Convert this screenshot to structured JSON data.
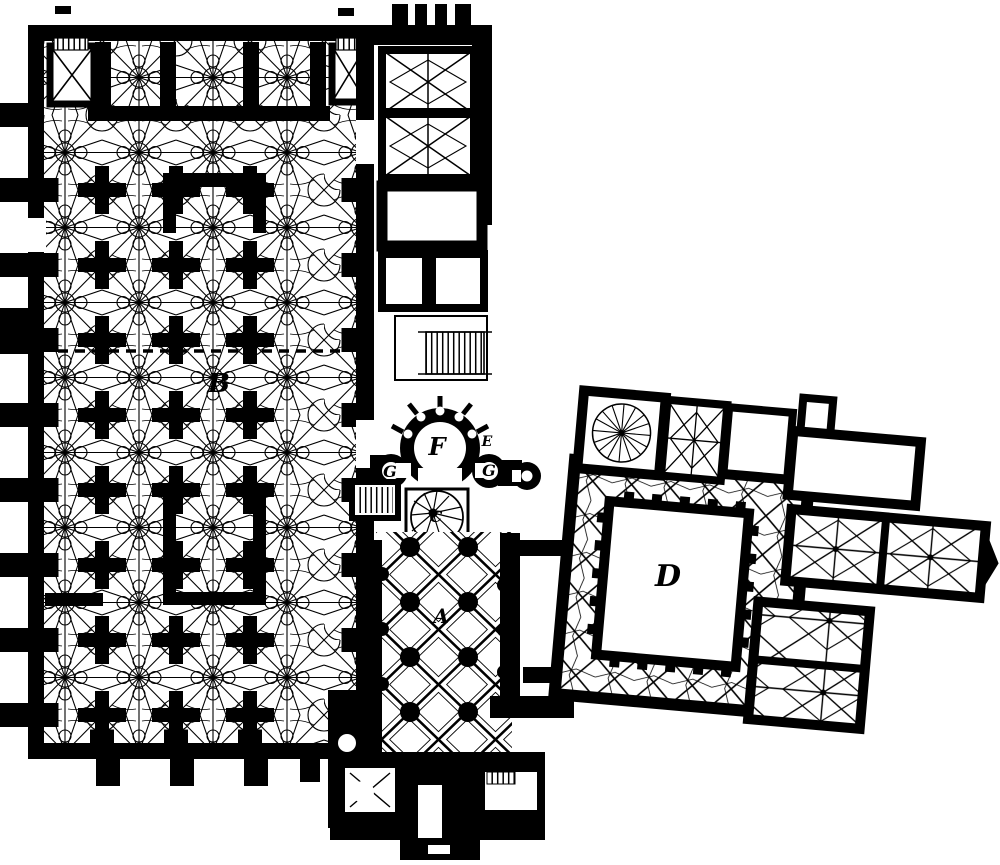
{
  "figure": {
    "kind": "engraved architectural floor plan",
    "subject": "Gothic hall church with rib-vaulted nave, apsed east chapel and adjoining cloister with central courtyard",
    "paper_color": "#ffffff",
    "ink_color": "#000000"
  },
  "labels": [
    {
      "char": "B",
      "room": "nave-hall",
      "x": 219,
      "y": 384,
      "size": 26
    },
    {
      "char": "F",
      "room": "main-apse",
      "x": 437,
      "y": 447,
      "size": 24
    },
    {
      "char": "E",
      "room": "apse-annex",
      "x": 487,
      "y": 442,
      "size": 14
    },
    {
      "char": "G",
      "room": "side-apse-left",
      "x": 390,
      "y": 472,
      "size": 16
    },
    {
      "char": "G",
      "room": "side-apse-right",
      "x": 489,
      "y": 471,
      "size": 16
    },
    {
      "char": "C",
      "room": "spiral-stair",
      "x": 436,
      "y": 517,
      "size": 16
    },
    {
      "char": "A",
      "room": "choir",
      "x": 441,
      "y": 616,
      "size": 20
    },
    {
      "char": "D",
      "room": "cloister-courtyard",
      "x": 668,
      "y": 577,
      "size": 30
    }
  ]
}
